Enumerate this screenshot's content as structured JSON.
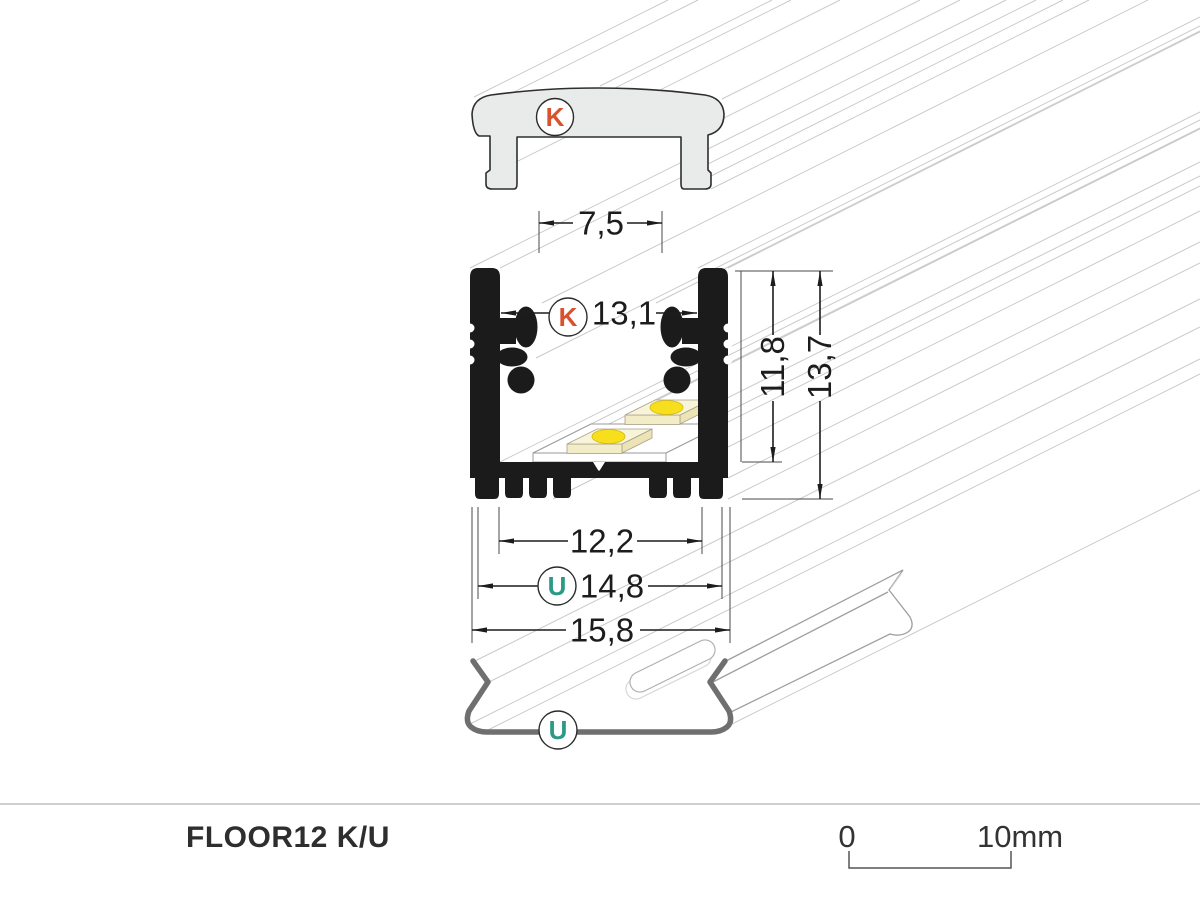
{
  "drawing": {
    "product_label": "FLOOR12 K/U",
    "labels": {
      "cover_marker": "K",
      "profile_marker": "K",
      "clip_dim_marker": "U",
      "clip_marker": "U"
    },
    "dimensions": {
      "cover_width": "7,5",
      "opening_width": "13,1",
      "inner_height": "11,8",
      "total_height": "13,7",
      "base_width": "12,2",
      "clip_width": "14,8",
      "total_width": "15,8"
    },
    "scale_bar": {
      "start": "0",
      "end": "10mm"
    },
    "colors": {
      "k_marker": "#d9522e",
      "u_marker": "#2a9a86",
      "profile_black": "#1b1b1b",
      "cover_gray": "#e9ebea",
      "clip_gray": "#6f6f6f",
      "extrusion_line": "#c9c9c9",
      "dimension_text": "#1c1c1c"
    }
  }
}
